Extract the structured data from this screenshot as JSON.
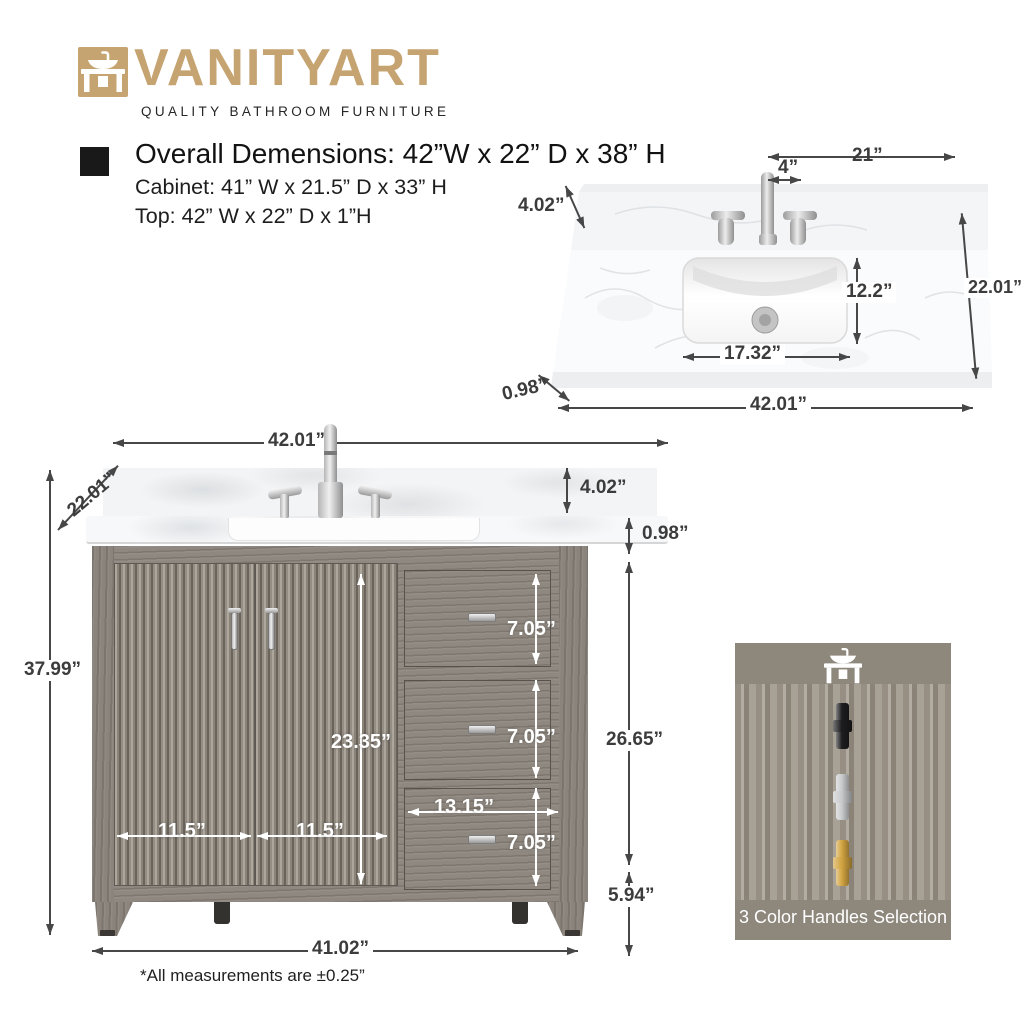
{
  "colors": {
    "brand": "#c5a472",
    "dim_text": "#3c3c3c",
    "wood": "#8e8880",
    "panel_bg": "#8d877c",
    "marble": "#f7f8f9"
  },
  "logo": {
    "brand": "VANITYART",
    "tagline": "QUALITY BATHROOM FURNITURE",
    "icon": "vanity-sink-icon"
  },
  "specs": {
    "title": "Overall Demensions: 42”W x 22” D x 38” H",
    "cabinet": "Cabinet: 41” W x 21.5” D x 33” H",
    "top": "Top: 42” W x 22” D x 1”H"
  },
  "top_view": {
    "dims": {
      "half_width": "21”",
      "faucet_offset": "4”",
      "backsplash_height": "4.02”",
      "depth": "22.01”",
      "sink_depth": "12.2”",
      "sink_width": "17.32”",
      "top_thickness": "0.98”",
      "overall_width": "42.01”"
    }
  },
  "front_view": {
    "dims": {
      "top_width": "42.01”",
      "depth": "22.01”",
      "overall_height": "37.99”",
      "backsplash_height": "4.02”",
      "top_thickness": "0.98”",
      "door_height": "23.35”",
      "left_door_width": "11.5”",
      "right_door_width": "11.5”",
      "drawer_width": "13.15”",
      "drawer_heights": [
        "7.05”",
        "7.05”",
        "7.05”"
      ],
      "body_height": "26.65”",
      "leg_height": "5.94”",
      "base_width": "41.02”"
    },
    "note": "*All measurements are ±0.25”"
  },
  "handles_panel": {
    "caption": "3 Color Handles Selection",
    "icon": "vanity-sink-icon",
    "options": [
      {
        "name": "black-handle",
        "color": "#1d1d1f"
      },
      {
        "name": "chrome-handle",
        "color": "#c9cacc"
      },
      {
        "name": "gold-handle",
        "color": "#d2a441"
      }
    ]
  }
}
